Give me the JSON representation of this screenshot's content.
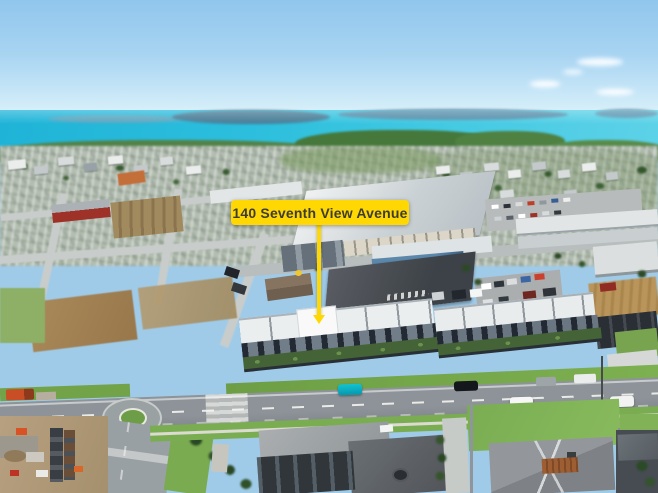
{
  "annotation": {
    "label": "140 Seventh View Avenue"
  },
  "colors": {
    "callout_bg": "#ffd803",
    "callout_text": "#3e3c30",
    "sky_top": "#93c4e7",
    "sky_horizon": "#e0f2f8",
    "sea": "#35bcd8",
    "coast_green": "#55814b",
    "grass_verge": "#7cab57",
    "asphalt": "#878d91",
    "subject_roof_white": "#f6f7f6",
    "teal_car": "#19b6c6"
  }
}
